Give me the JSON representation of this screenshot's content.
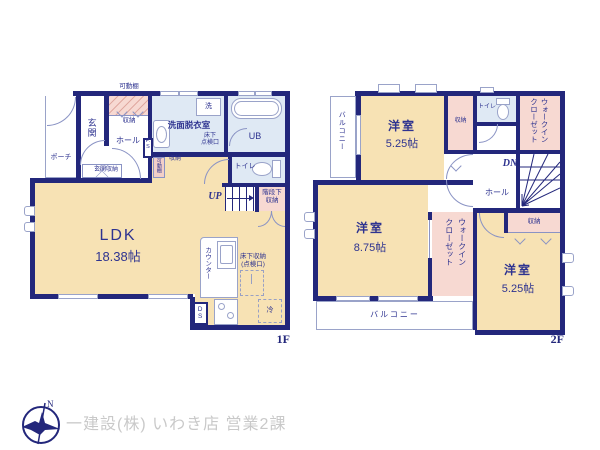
{
  "colors": {
    "wall": "#23277b",
    "room_floor": "#f7e2b4",
    "closet": "#f7d9d2",
    "wet_area": "#dfe9f4",
    "label_text": "#2e3390",
    "watermark": "#c9c9c9"
  },
  "f1": {
    "floor_label": "1F",
    "shelf_top": "可動棚",
    "porch": "ポーチ",
    "entrance": "玄関",
    "entrance_storage": "玄関収納",
    "hall_storage": "収納",
    "hall": "ホール",
    "ps": "P.S",
    "washer": "洗",
    "washroom": "洗面脱衣室",
    "underfloor_hatch": "床下\n点検口",
    "bath": "UB",
    "toilet": "トイレ",
    "shelf_small": "可動棚",
    "storage_small": "収納",
    "stairs_up": "UP",
    "under_stair_storage": "階段下\n収納",
    "ldk_name": "LDK",
    "ldk_size": "18.38帖",
    "counter": "カウンター",
    "underfloor_storage": "床下収納\n(点検口)",
    "duct": "DS",
    "fridge": "冷"
  },
  "f2": {
    "floor_label": "2F",
    "balcony_left": "バルコニー",
    "room1_name": "洋室",
    "room1_size": "5.25帖",
    "storage_top": "収納",
    "toilet": "トイレ",
    "wic_top": "ウォークイン\nクローゼット",
    "stairs_down": "DN",
    "hall": "ホール",
    "room2_name": "洋室",
    "room2_size": "8.75帖",
    "wic_mid": "ウォークイン\nクローゼット",
    "storage_right": "収納",
    "room3_name": "洋室",
    "room3_size": "5.25帖",
    "balcony_bottom": "バルコニー"
  },
  "footer": {
    "company": "一建設(株) いわき店 営業2課",
    "north": "N"
  }
}
